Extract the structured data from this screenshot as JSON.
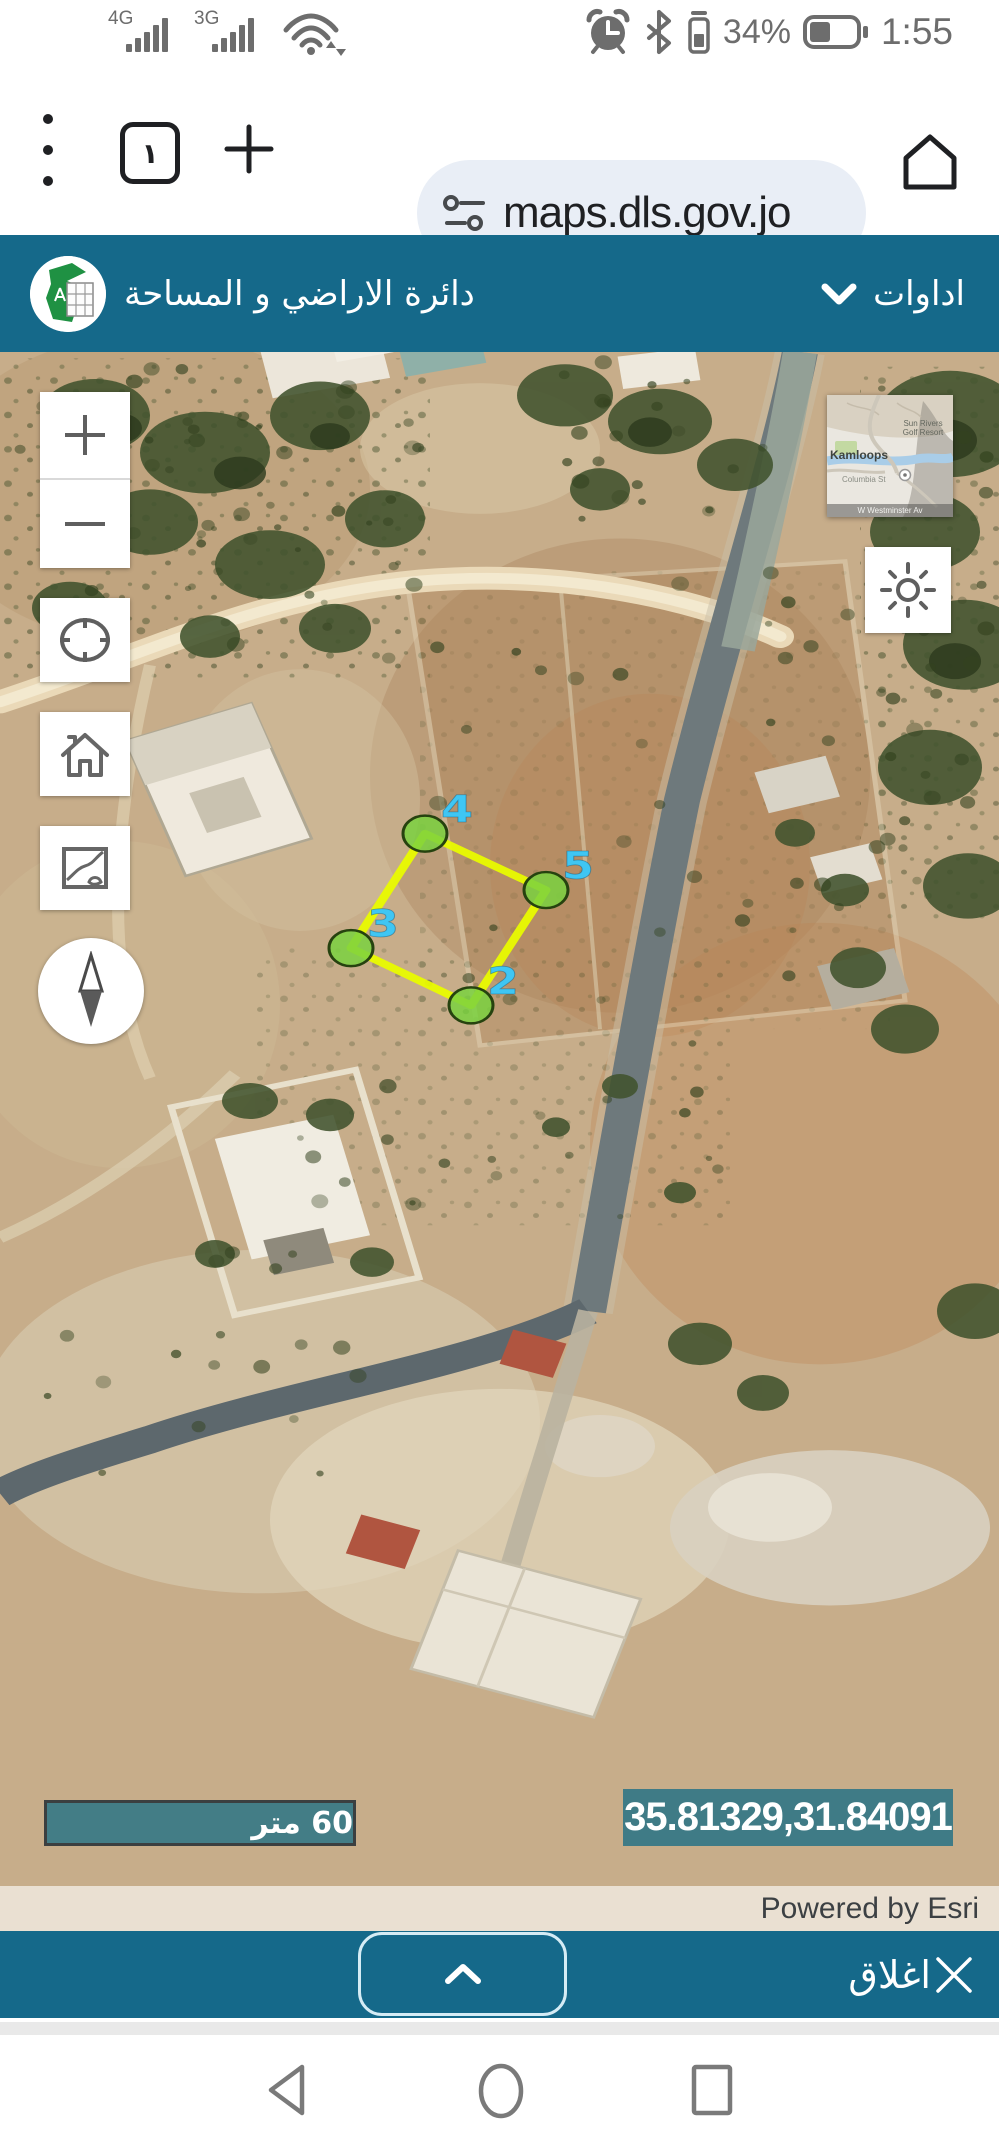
{
  "status_bar": {
    "time": "1:55",
    "battery_percent": "34%",
    "network_badges": [
      "4G",
      "3G"
    ],
    "icon_names": [
      "signal-4g",
      "signal-3g",
      "wifi",
      "alarm",
      "bluetooth",
      "earbud-battery",
      "battery"
    ]
  },
  "browser": {
    "tab_count": "١",
    "url": "maps.dls.gov.jo"
  },
  "header": {
    "title": "دائرة الاراضي و المساحة",
    "tools_label": "اداوات"
  },
  "map": {
    "scale_label": "60 متر",
    "coordinates": "35.81329,31.84091",
    "attribution": "Powered by Esri",
    "inset": {
      "city": "Kamloops",
      "poi": "Sun Rivers Golf Resort",
      "street": "Columbia St",
      "bottom_street": "W Westminster Av"
    },
    "measure": {
      "edge_order": [
        "4",
        "5",
        "2",
        "3"
      ],
      "vertices": [
        {
          "label": "2",
          "x": 471,
          "y": 1151
        },
        {
          "label": "3",
          "x": 351,
          "y": 1081
        },
        {
          "label": "4",
          "x": 425,
          "y": 941
        },
        {
          "label": "5",
          "x": 546,
          "y": 1010
        }
      ],
      "colors": {
        "vertex_fill": "#7ad13f",
        "vertex_stroke": "#26420f",
        "edge": "#e9fb00",
        "label": "#3fc6f3"
      }
    },
    "theme": {
      "teal": "#15698a",
      "panel_teal": "#2c7485"
    }
  },
  "footer": {
    "close_label": "اغلاق"
  }
}
